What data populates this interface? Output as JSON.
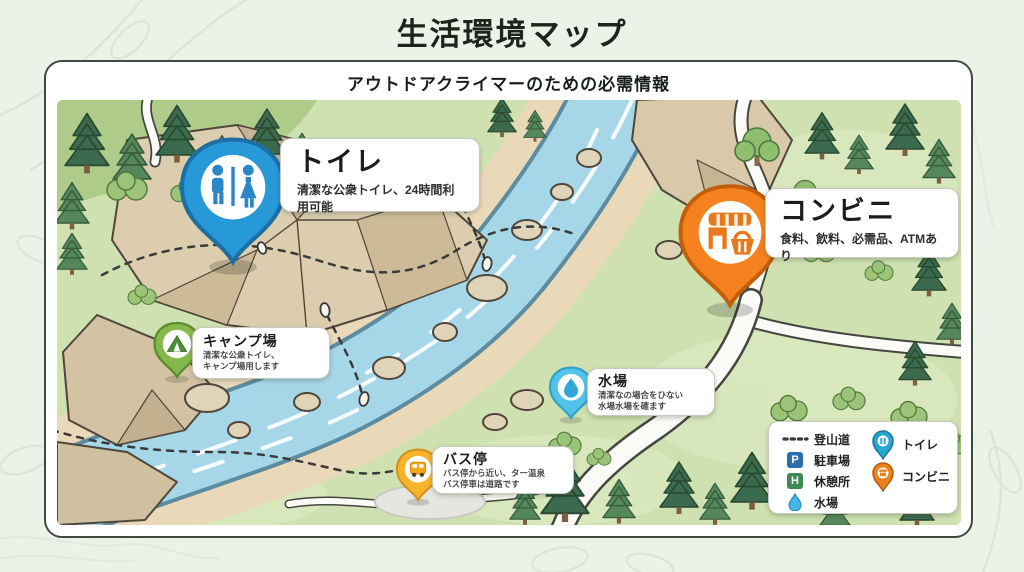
{
  "header": {
    "title": "生活環境マップ",
    "subtitle": "アウトドアクライマーのための必需情報"
  },
  "markers": {
    "toilet": {
      "name": "トイレ",
      "description": "清潔な公衆トイレ、24時間利用可能",
      "pin_color": "#2798d8"
    },
    "convenience": {
      "name": "コンビニ",
      "description": "食料、飲料、必需品、ATMあり",
      "pin_color": "#f5821f"
    },
    "campground": {
      "name": "キャンプ場",
      "description_line1": "清潔な公衆トイレ、",
      "description_line2": "キャンプ場用します",
      "pin_color": "#84b84c"
    },
    "water": {
      "name": "水場",
      "description_line1": "清潔なの場合をひない",
      "description_line2": "水場水場を確ます",
      "pin_color": "#54c3ea"
    },
    "bus_stop": {
      "name": "バス停",
      "description_line1": "バス停から近い、ター温泉",
      "description_line2": "バス停車は道路です",
      "pin_color": "#f7b32b"
    }
  },
  "legend": {
    "trail": {
      "label": "登山道"
    },
    "parking": {
      "label": "駐車場",
      "badge": "P",
      "color": "#2e6cb0"
    },
    "rest_area": {
      "label": "休憩所",
      "badge": "H",
      "color": "#3e8a55"
    },
    "water": {
      "label": "水場",
      "color": "#45b5e8"
    },
    "toilet": {
      "label": "トイレ",
      "color": "#2aa5cf"
    },
    "convenience": {
      "label": "コンビニ",
      "color": "#e8821e"
    }
  }
}
